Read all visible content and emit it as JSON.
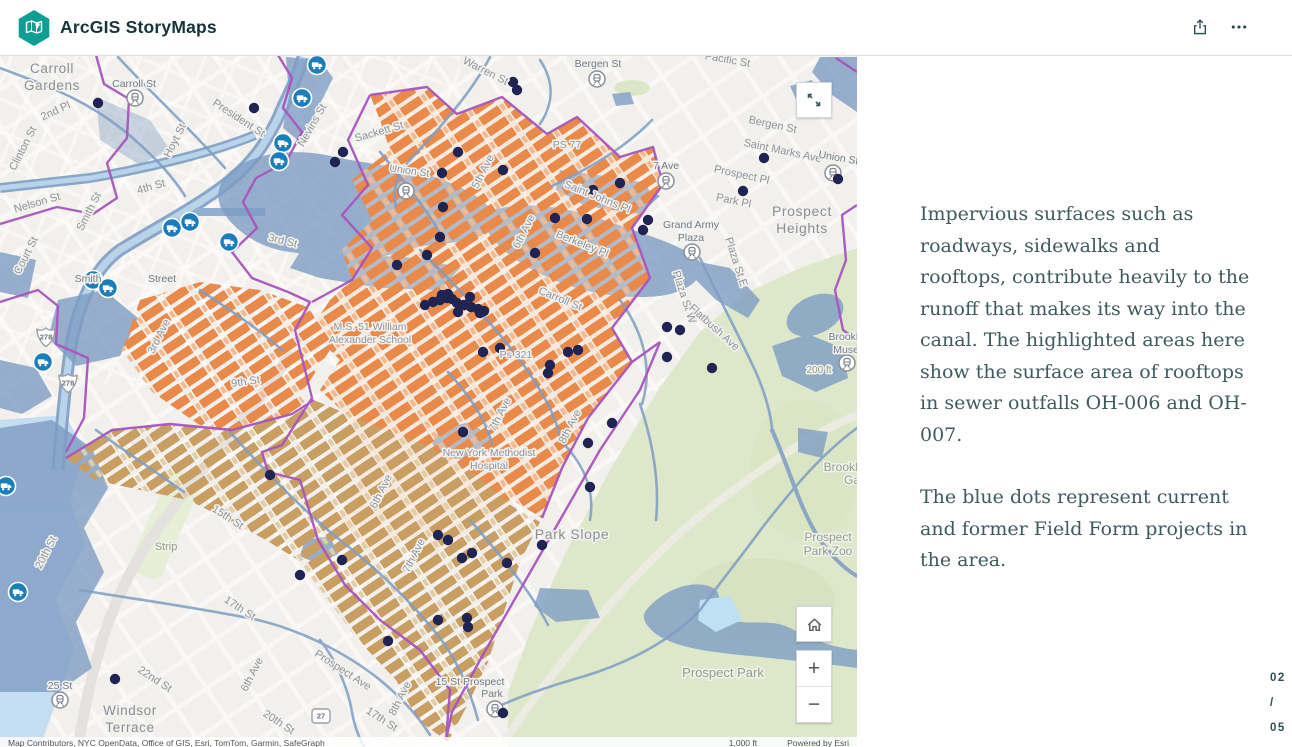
{
  "header": {
    "app_title": "ArcGIS StoryMaps"
  },
  "story": {
    "paragraph1": "Impervious surfaces such as roadways, sidewalks and rooftops, contribute heavily to the runoff that makes its way into the canal. The highlighted areas here show the surface area of rooftops in sewer outfalls OH-006 and OH-007.",
    "paragraph2": "The blue dots represent current and former Field Form projects in the area."
  },
  "pager": {
    "current": "02",
    "separator": "/",
    "total": "05"
  },
  "map_controls": {
    "zoom_in": "+",
    "zoom_out": "−"
  },
  "map": {
    "attribution_sources": "Map Contributors, NYC OpenData, Office of GIS, Esri, TomTom, Garmin, SafeGraph",
    "attribution_scale": "1,000 ft",
    "attribution_powered": "Powered by Esri",
    "colors": {
      "rooftop_orange": "#e9894a",
      "rooftop_tan": "#c99e63",
      "boundary_purple": "#a855bd",
      "project_dot_navy": "#1f2452",
      "water_slate": "#7e9dc3",
      "park_green": "#dde7ca",
      "facility_blue": "#1b7dba"
    },
    "labels": [
      [
        "Carroll",
        52,
        73,
        0,
        13.5,
        "nb"
      ],
      [
        "Gardens",
        52,
        90,
        0,
        13.5,
        "nb"
      ],
      [
        "Carroll St",
        134,
        87,
        0,
        10.5,
        "stn"
      ],
      [
        "2nd Pl",
        57,
        114,
        -25,
        11,
        "st"
      ],
      [
        "President St",
        237,
        121,
        33,
        11,
        "st"
      ],
      [
        "Clinton St",
        26,
        150,
        -63,
        11,
        "st"
      ],
      [
        "Hoyt St",
        178,
        142,
        -63,
        11,
        "st"
      ],
      [
        "Nelson St",
        38,
        206,
        -16,
        11,
        "st"
      ],
      [
        "4th St",
        152,
        190,
        -16,
        11,
        "st"
      ],
      [
        "Smith St",
        92,
        213,
        -63,
        11,
        "st"
      ],
      [
        "Court St",
        29,
        257,
        -63,
        11,
        "st"
      ],
      [
        "Nevins St",
        315,
        127,
        -60,
        11,
        "st"
      ],
      [
        "Sackett St",
        380,
        135,
        -16,
        11,
        "st"
      ],
      [
        "Union St",
        409,
        174,
        8,
        10.5,
        "st"
      ],
      [
        "Warren St",
        484,
        74,
        27,
        11,
        "st"
      ],
      [
        "Bergen St",
        598,
        67,
        0,
        10.5,
        "stn"
      ],
      [
        "Pacific St",
        727,
        63,
        10,
        11,
        "st"
      ],
      [
        "Bergen St",
        772,
        128,
        12,
        11,
        "st"
      ],
      [
        "Saint Marks Ave",
        782,
        154,
        12,
        11,
        "st"
      ],
      [
        "Prospect Pl",
        741,
        178,
        12,
        11,
        "st"
      ],
      [
        "Park Pl",
        733,
        204,
        12,
        11,
        "st"
      ],
      [
        "Prospect",
        802,
        216,
        0,
        14,
        "nb"
      ],
      [
        "Heights",
        802,
        233,
        0,
        14,
        "nb"
      ],
      [
        "PS 77",
        567,
        148,
        0,
        10.5,
        "st"
      ],
      [
        "7 Ave",
        666,
        169,
        0,
        10.5,
        "stn"
      ],
      [
        "Saint Johns Pl",
        596,
        200,
        22,
        11,
        "st"
      ],
      [
        "Berkeley Pl",
        581,
        247,
        22,
        11,
        "st"
      ],
      [
        "Grand Army",
        691,
        228,
        0,
        10.5,
        "stn"
      ],
      [
        "Plaza",
        691,
        241,
        0,
        10.5,
        "stn"
      ],
      [
        "Plaza St E",
        733,
        263,
        72,
        11,
        "st"
      ],
      [
        "Plaza St W",
        681,
        298,
        72,
        11,
        "st"
      ],
      [
        "Flatbush Ave",
        712,
        330,
        42,
        11,
        "st"
      ],
      [
        "Carroll St",
        559,
        302,
        22,
        11,
        "st"
      ],
      [
        "Ps 321",
        516,
        358,
        0,
        10.5,
        "st"
      ],
      [
        "3rd St",
        282,
        244,
        14,
        11,
        "st"
      ],
      [
        "Smith",
        88,
        282,
        0,
        10.5,
        "stn"
      ],
      [
        "Street",
        162,
        282,
        0,
        10.5,
        "stn"
      ],
      [
        "5th Ave",
        486,
        173,
        -63,
        11,
        "st"
      ],
      [
        "6th Ave",
        527,
        233,
        -63,
        11,
        "st"
      ],
      [
        "M.S. 51 William",
        370,
        330,
        0,
        10.5,
        "st"
      ],
      [
        "Alexander School",
        370,
        343,
        0,
        10.5,
        "st"
      ],
      [
        "New York Methodist",
        489,
        456,
        0,
        10.5,
        "st"
      ],
      [
        "Hospital",
        489,
        469,
        0,
        10.5,
        "st"
      ],
      [
        "Park Slope",
        572,
        539,
        0,
        14,
        "nb"
      ],
      [
        "7th Ave",
        503,
        416,
        -63,
        11,
        "st"
      ],
      [
        "8th Ave",
        573,
        428,
        -63,
        11,
        "st"
      ],
      [
        "Prospect",
        828,
        541,
        0,
        12,
        "pk"
      ],
      [
        "Park Zoo",
        828,
        555,
        0,
        12,
        "pk"
      ],
      [
        "Prospect Park",
        723,
        677,
        0,
        13,
        "pk"
      ],
      [
        "Brookly",
        846,
        340,
        0,
        10.5,
        "stn"
      ],
      [
        "Museu",
        849,
        353,
        0,
        10.5,
        "stn"
      ],
      [
        "Brooklyn",
        847,
        471,
        0,
        12,
        "pk"
      ],
      [
        "Ga",
        852,
        484,
        0,
        12,
        "pk"
      ],
      [
        "200 ft",
        819,
        373,
        0,
        10,
        "pk"
      ],
      [
        "Windsor",
        130,
        715,
        0,
        13.5,
        "nb"
      ],
      [
        "Terrace",
        130,
        732,
        0,
        13.5,
        "nb"
      ],
      [
        "22nd St",
        153,
        682,
        33,
        11,
        "st"
      ],
      [
        "20th St",
        277,
        725,
        33,
        11,
        "st"
      ],
      [
        "17th St",
        380,
        722,
        33,
        11,
        "st"
      ],
      [
        "Prospect Ave",
        341,
        673,
        33,
        11,
        "st"
      ],
      [
        "17th St",
        238,
        611,
        33,
        11,
        "st"
      ],
      [
        "20th St",
        49,
        554,
        -63,
        11,
        "st"
      ],
      [
        "25 St",
        60,
        689,
        0,
        10.5,
        "stn"
      ],
      [
        "15th St",
        226,
        520,
        33,
        11,
        "st"
      ],
      [
        "6th Ave",
        384,
        493,
        -63,
        11,
        "st"
      ],
      [
        "7th Ave",
        417,
        557,
        -63,
        11,
        "st"
      ],
      [
        "8th Ave",
        403,
        700,
        -63,
        11,
        "st"
      ],
      [
        "6th Ave",
        255,
        676,
        -63,
        11,
        "st"
      ],
      [
        "Strip",
        166,
        550,
        0,
        11,
        "pk"
      ],
      [
        "15 St Prospect",
        470,
        685,
        0,
        10.5,
        "stn"
      ],
      [
        "Park",
        492,
        697,
        0,
        10.5,
        "stn"
      ],
      [
        "9th St",
        246,
        385,
        -8,
        11,
        "st"
      ],
      [
        "3rd Ave",
        162,
        338,
        -63,
        11,
        "st"
      ],
      [
        "Union St",
        838,
        161,
        10,
        10.5,
        "stn"
      ]
    ],
    "project_dots": [
      [
        98,
        103
      ],
      [
        254,
        108
      ],
      [
        343,
        152
      ],
      [
        335,
        162
      ],
      [
        397,
        265
      ],
      [
        427,
        255
      ],
      [
        513,
        82
      ],
      [
        517,
        90
      ],
      [
        458,
        152
      ],
      [
        442,
        173
      ],
      [
        503,
        170
      ],
      [
        443,
        207
      ],
      [
        620,
        183
      ],
      [
        593,
        190
      ],
      [
        743,
        191
      ],
      [
        838,
        179
      ],
      [
        764,
        158
      ],
      [
        555,
        218
      ],
      [
        587,
        219
      ],
      [
        648,
        220
      ],
      [
        643,
        230
      ],
      [
        535,
        253
      ],
      [
        440,
        237
      ],
      [
        425,
        305
      ],
      [
        433,
        302
      ],
      [
        440,
        300
      ],
      [
        448,
        294
      ],
      [
        452,
        299
      ],
      [
        457,
        303
      ],
      [
        464,
        305
      ],
      [
        471,
        307
      ],
      [
        478,
        309
      ],
      [
        470,
        297
      ],
      [
        484,
        311
      ],
      [
        442,
        295
      ],
      [
        447,
        298
      ],
      [
        458,
        312
      ],
      [
        480,
        313
      ],
      [
        500,
        348
      ],
      [
        483,
        352
      ],
      [
        550,
        365
      ],
      [
        548,
        373
      ],
      [
        568,
        352
      ],
      [
        578,
        350
      ],
      [
        667,
        327
      ],
      [
        680,
        330
      ],
      [
        667,
        357
      ],
      [
        712,
        368
      ],
      [
        463,
        432
      ],
      [
        588,
        443
      ],
      [
        612,
        423
      ],
      [
        590,
        487
      ],
      [
        438,
        535
      ],
      [
        448,
        540
      ],
      [
        462,
        558
      ],
      [
        472,
        553
      ],
      [
        507,
        563
      ],
      [
        542,
        545
      ],
      [
        438,
        620
      ],
      [
        468,
        627
      ],
      [
        467,
        618
      ],
      [
        503,
        713
      ],
      [
        270,
        475
      ],
      [
        342,
        560
      ],
      [
        300,
        575
      ],
      [
        115,
        679
      ],
      [
        388,
        641
      ]
    ],
    "stations": [
      [
        135,
        98
      ],
      [
        597,
        79
      ],
      [
        666,
        181
      ],
      [
        692,
        252
      ],
      [
        847,
        363
      ],
      [
        406,
        191
      ],
      [
        60,
        700
      ],
      [
        495,
        709
      ],
      [
        833,
        173
      ]
    ],
    "facilities": [
      [
        317,
        65
      ],
      [
        302,
        98
      ],
      [
        283,
        143
      ],
      [
        279,
        161
      ],
      [
        190,
        222
      ],
      [
        172,
        228
      ],
      [
        229,
        242
      ],
      [
        93,
        280
      ],
      [
        108,
        288
      ],
      [
        43,
        362
      ],
      [
        6,
        486
      ],
      [
        18,
        592
      ]
    ],
    "shields": [
      {
        "t": "278",
        "k": "i",
        "x": 46,
        "y": 337
      },
      {
        "t": "278",
        "k": "i",
        "x": 68,
        "y": 383
      },
      {
        "t": "27",
        "k": "s",
        "x": 321,
        "y": 716
      }
    ]
  }
}
